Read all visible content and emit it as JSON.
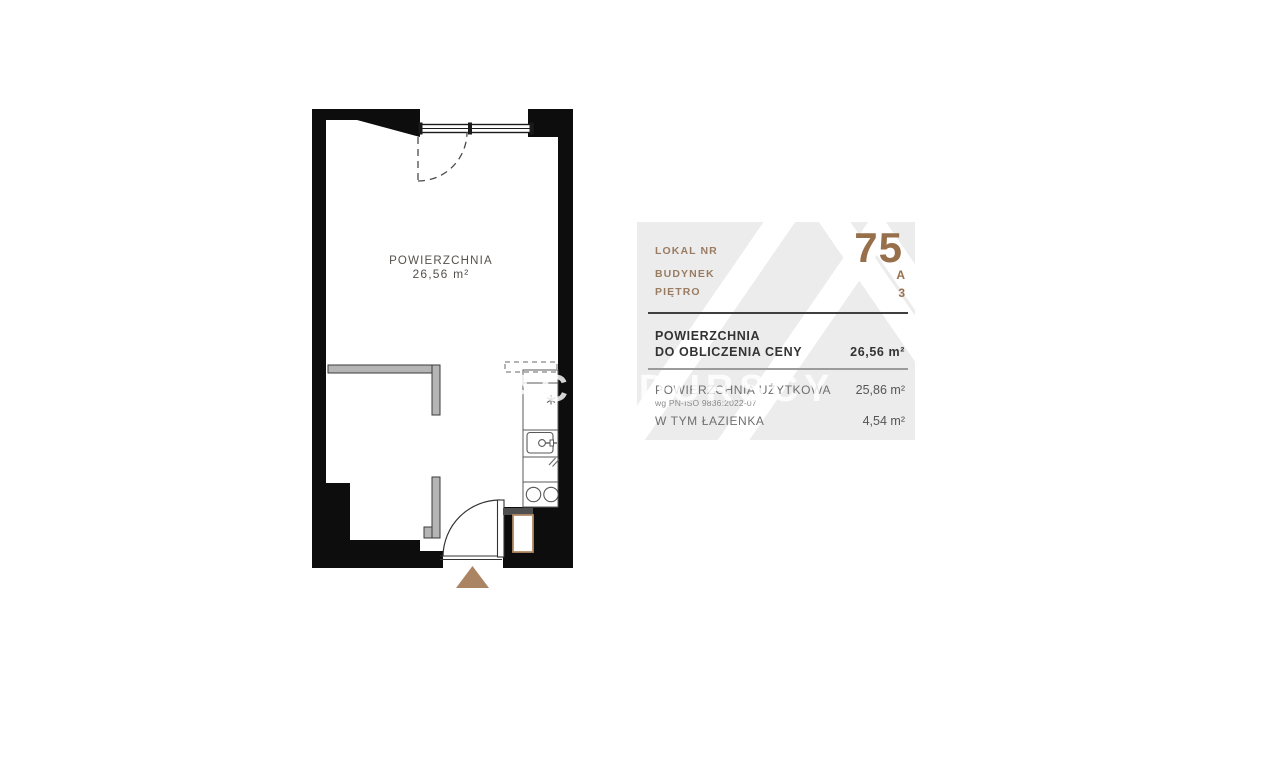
{
  "watermark": {
    "text": "BRACIA DURSCY"
  },
  "floor_plan": {
    "area_label": "POWIERZCHNIA",
    "area_value": "26,56 m²"
  },
  "info_panel": {
    "unit": {
      "label": "LOKAL NR",
      "value": "75"
    },
    "building": {
      "label": "BUDYNEK",
      "value": "A"
    },
    "floor": {
      "label": "PIĘTRO",
      "value": "3"
    },
    "price_area": {
      "label_line1": "POWIERZCHNIA",
      "label_line2": "DO OBLICZENIA CENY",
      "value": "26,56 m²"
    },
    "usable_area": {
      "label": "POWIERZCHNIA UŻYTKOWA",
      "note": "wg PN-ISO 9836:2022-07",
      "value": "25,86 m²"
    },
    "bathroom_area": {
      "label": "W TYM ŁAZIENKA",
      "value": "4,54 m²"
    }
  },
  "colors": {
    "wall_black": "#0d0d0d",
    "partition_gray": "#b5b5b5",
    "panel_bg": "#ececec",
    "accent_brown": "#976f4a",
    "label_brown": "#9a7c62",
    "entrance_tan": "#ab8464"
  }
}
